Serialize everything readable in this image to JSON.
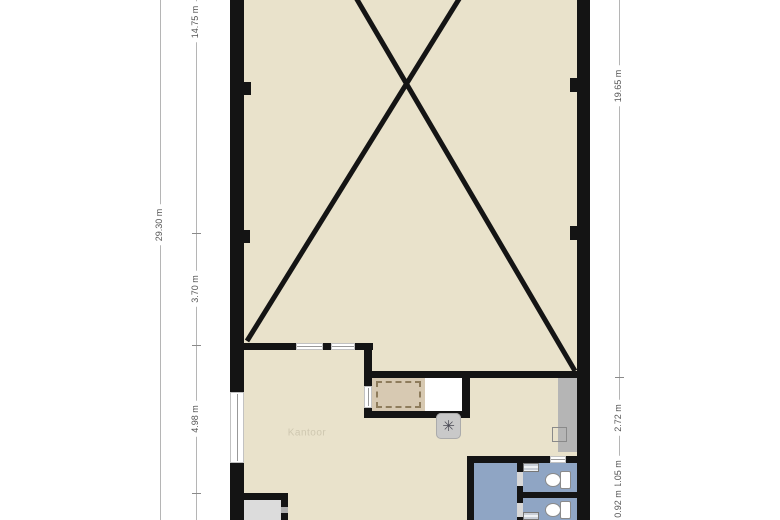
{
  "dimensions": {
    "left_outer": "29.30 m",
    "left_inner": [
      "14.75 m",
      "3.70 m",
      "4.98 m"
    ],
    "right": [
      "19.65 m",
      "2.72 m",
      "1.05 m",
      "0.92 m"
    ]
  },
  "rooms": {
    "office_label": "Kantoor"
  },
  "icons": {
    "ventilation_glyph": "✳"
  },
  "colors": {
    "floor": "#e9e2cb",
    "wall": "#141414",
    "wet_room_blue": "#8fa5c4",
    "stair_closet": "#d7c9b2",
    "closet_dash": "#8e7c5c",
    "counter_gray": "#b5b5b5",
    "storage_gray": "#dcdcdc",
    "dim_line": "#b5b5b5",
    "dim_text": "#555555"
  }
}
